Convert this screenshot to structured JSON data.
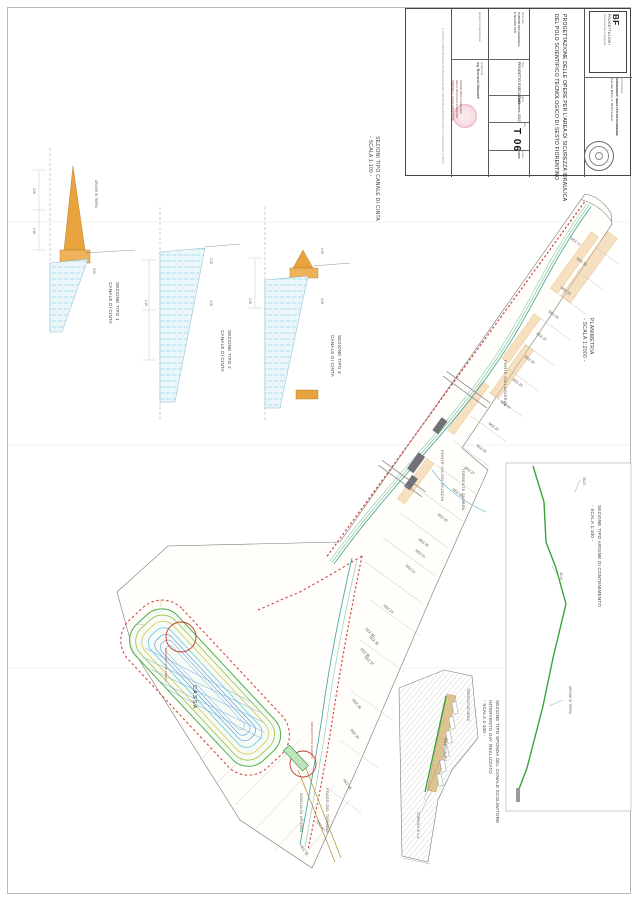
{
  "colors": {
    "canal": "#49a8a2",
    "canal_light": "#8fd0cb",
    "green": "#3aa33a",
    "red_dashed": "#cc4b44",
    "levee_orange": "#e8a33d",
    "tan_fill": "#eec690",
    "channel_blue": "#74c4dd",
    "building_gray": "#707076",
    "basin_green": "#4caf50",
    "basin_olive": "#9ebf3b",
    "basin_yellow": "#d4c23a",
    "basin_cyan": "#57c0d8",
    "basin_blue": "#4a90d9"
  },
  "sheet": {
    "logo": {
      "line1": "BF",
      "line2": "PROGETTAZIONI",
      "line3": "studio associato di ingegneria"
    },
    "committente": {
      "label": "committente:",
      "name": "UNIVERSITA' DEGLI STUDI DI FIRENZE",
      "address": "P.za San Marco, 4 - 50121 Firenze"
    },
    "title": {
      "line1": "PROGETTAZIONE DELLE OPERE PER L'AREA DI SICUREZZA IDRAULICA",
      "line2": "DEL POLO SCIENTIFICO TECNOLOGICO DI SESTO FIORENTINO"
    },
    "fields": {
      "gruppo_label": "gruppo di progettazione:",
      "prog_label": "progettista:",
      "progettista": "ing. Bernardo Mazzanti",
      "oggetto_label": "elaborato:",
      "oggetto1": "PLANIMETRIA GENERALE",
      "oggetto2": "E SEZIONI TIPO",
      "fase_label": "fase:",
      "fase": "PROGETTO ESECUTIVO",
      "data_label": "data:",
      "data": "Settembre 2022",
      "tav_label": "tav:",
      "tav": "T 06",
      "scala_label": "scala:",
      "scala": "varie"
    },
    "ordine": [
      "ORDINE DEGLI INGEGNERI",
      "DELLA PROVINCIA DI FIRENZE",
      "SEZIONE A - CIVILE AMBIENTALE"
    ],
    "nota": "E' VIETATA LA RIPRODUZIONE ANCHE PARZIALE DEL PRESENTE ELABORATO SENZA AUTORIZZAZIONE SCRITTA"
  },
  "captions": {
    "sezioni": [
      "SEZIONI TIPO CANALE DI CINTA",
      "- SCALA 1:100 -"
    ],
    "planimetria": [
      "PLANIMETRIA",
      "- SCALA 1:2000 -"
    ],
    "argine": [
      "SEZIONE TIPO ARGINE DI CONTENIMENTO",
      "- SCALA 1:100 -"
    ],
    "sponda": [
      "SEZIONE TIPO SPONDA DEL CANALE SCOLMATORE",
      "INTERVENTO GIA' REALIZZATO",
      "- SCALA 1:100 -"
    ]
  },
  "plan": {
    "sez_labels": [
      {
        "t": "SEZ 17",
        "x": 570,
        "y": 239,
        "r": 36
      },
      {
        "t": "SEZ 18",
        "x": 576,
        "y": 259,
        "r": 36
      },
      {
        "t": "SEZ 19",
        "x": 560,
        "y": 288,
        "r": 36
      },
      {
        "t": "SEZ 20",
        "x": 548,
        "y": 312,
        "r": 36
      },
      {
        "t": "SEZ 21",
        "x": 536,
        "y": 334,
        "r": 36
      },
      {
        "t": "SEZ 22",
        "x": 524,
        "y": 357,
        "r": 36
      },
      {
        "t": "SEZ 23",
        "x": 512,
        "y": 380,
        "r": 36
      },
      {
        "t": "SEZ 24",
        "x": 500,
        "y": 402,
        "r": 36
      },
      {
        "t": "SEZ 25",
        "x": 488,
        "y": 424,
        "r": 36
      },
      {
        "t": "SEZ 26",
        "x": 476,
        "y": 446,
        "r": 36
      },
      {
        "t": "SEZ 27",
        "x": 464,
        "y": 468,
        "r": 36
      },
      {
        "t": "SEZ 28",
        "x": 452,
        "y": 490,
        "r": 36
      },
      {
        "t": "SEZ 29",
        "x": 437,
        "y": 515,
        "r": 36
      },
      {
        "t": "SEZ 30",
        "x": 418,
        "y": 540,
        "r": 36
      },
      {
        "t": "SEZ 31",
        "x": 415,
        "y": 551,
        "r": 38
      },
      {
        "t": "SEZ 32",
        "x": 405,
        "y": 566,
        "r": 40
      },
      {
        "t": "SEZ 33",
        "x": 383,
        "y": 606,
        "r": 40
      },
      {
        "t": "SEZ 34",
        "x": 365,
        "y": 629,
        "r": 45
      },
      {
        "t": "SEZ 35",
        "x": 369,
        "y": 637,
        "r": 45
      },
      {
        "t": "SEZ 36",
        "x": 360,
        "y": 649,
        "r": 45
      },
      {
        "t": "SEZ 37",
        "x": 364,
        "y": 657,
        "r": 45
      },
      {
        "t": "SEZ 38",
        "x": 352,
        "y": 700,
        "r": 50
      },
      {
        "t": "SEZ 39",
        "x": 350,
        "y": 730,
        "r": 50
      },
      {
        "t": "SEZ 40",
        "x": 343,
        "y": 780,
        "r": 55
      },
      {
        "t": "SEZ 41",
        "x": 316,
        "y": 821,
        "r": 55
      },
      {
        "t": "SEZ 42",
        "x": 300,
        "y": 846,
        "r": 55
      }
    ],
    "street_labels": [
      {
        "t": "PONTE VIA LAZZERINI",
        "x": 508,
        "y": 360
      },
      {
        "t": "PONTE VIA DEI GIUNCHI",
        "x": 445,
        "y": 450
      },
      {
        "t": "TORRENTE ZAMBRA",
        "x": 466,
        "y": 468
      },
      {
        "t": "FOSSO DEL TERMINE",
        "x": 330,
        "y": 788
      },
      {
        "t": "SOGLIA DI SFIORO",
        "x": 304,
        "y": 793
      },
      {
        "t": "CASSA",
        "x": 197,
        "y": 685,
        "big": true
      }
    ],
    "red_labels": [
      {
        "t": "MANUFATTO DI PRESA",
        "x": 168,
        "y": 648
      },
      {
        "t": "MANUFATTO DI SCARICO",
        "x": 314,
        "y": 722
      }
    ]
  },
  "sections": {
    "s1": {
      "caption": [
        "SEZIONE TIPO 1",
        "CANALE DI CINTA"
      ],
      "labels": [
        {
          "t": "ARGINE IN TERRA",
          "x": 98,
          "y": 180
        },
        {
          "t": "2.00",
          "x": 36,
          "y": 188
        },
        {
          "t": "1.50",
          "x": 36,
          "y": 228
        },
        {
          "t": "3.50",
          "x": 96,
          "y": 268
        }
      ]
    },
    "s2": {
      "caption": [
        "SEZIONE TIPO 2",
        "CANALE DI CINTA"
      ],
      "labels": [
        {
          "t": "2.00",
          "x": 213,
          "y": 258
        },
        {
          "t": "4.00",
          "x": 213,
          "y": 300
        },
        {
          "t": "1.20",
          "x": 148,
          "y": 300
        }
      ]
    },
    "s3": {
      "caption": [
        "SEZIONE TIPO 3",
        "CANALE DI CINTA"
      ],
      "labels": [
        {
          "t": "1.50",
          "x": 324,
          "y": 248
        },
        {
          "t": "3.00",
          "x": 324,
          "y": 298
        },
        {
          "t": "1.00",
          "x": 252,
          "y": 298
        }
      ]
    }
  },
  "details": {
    "argine_labels": [
      {
        "t": "ARGINE IN TERRA",
        "x": 572,
        "y": 686
      },
      {
        "t": "38.20",
        "x": 586,
        "y": 477
      },
      {
        "t": "36.40",
        "x": 563,
        "y": 572
      }
    ],
    "sponda_labels": [
      {
        "t": "TERRENO NATURALE",
        "x": 470,
        "y": 688
      },
      {
        "t": "PALANCOLATO",
        "x": 447,
        "y": 738
      },
      {
        "t": "CORDOLO IN C.A.",
        "x": 420,
        "y": 812
      }
    ]
  }
}
